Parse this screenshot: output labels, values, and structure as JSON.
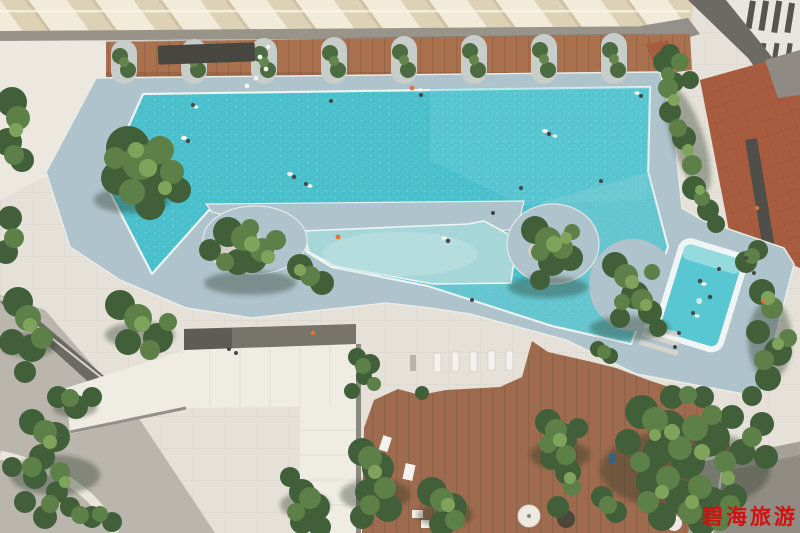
{
  "watermark": {
    "text": "碧海旅游",
    "color": "#d21010"
  },
  "scene": {
    "colors": {
      "pavement": "#e5e1d8",
      "pavement_dark": "#bab6ad",
      "roof_cream": "#f2ebd9",
      "walkway": "#99948a",
      "wood_deck_top": "#a9714e",
      "wood_deck_bottom": "#9e6b4e",
      "terracotta": "#a85c3f",
      "pool_deck": "#aec3cc",
      "pool_deep": "#4ac0cd",
      "pool_shallow": "#a6d6d8",
      "pool_channel": "#7fccd4",
      "kids_pool": "#59c7d2",
      "pool_rim": "#eff5f4",
      "island_ground": "#d8cfc0",
      "tree_dark": "#41603a",
      "tree_mid": "#5d8048",
      "tree_light": "#7ea45c",
      "tree_shadow": "#2c3826",
      "pavilion_roof": "#efece4",
      "dark_structure": "#6b6a63",
      "building_facade": "#e9e6df",
      "lounger_white": "#f4f2ec",
      "swimmer_dark": "#45474a",
      "swimmer_light": "#f6f4ef",
      "accent_orange": "#e0733c"
    }
  }
}
